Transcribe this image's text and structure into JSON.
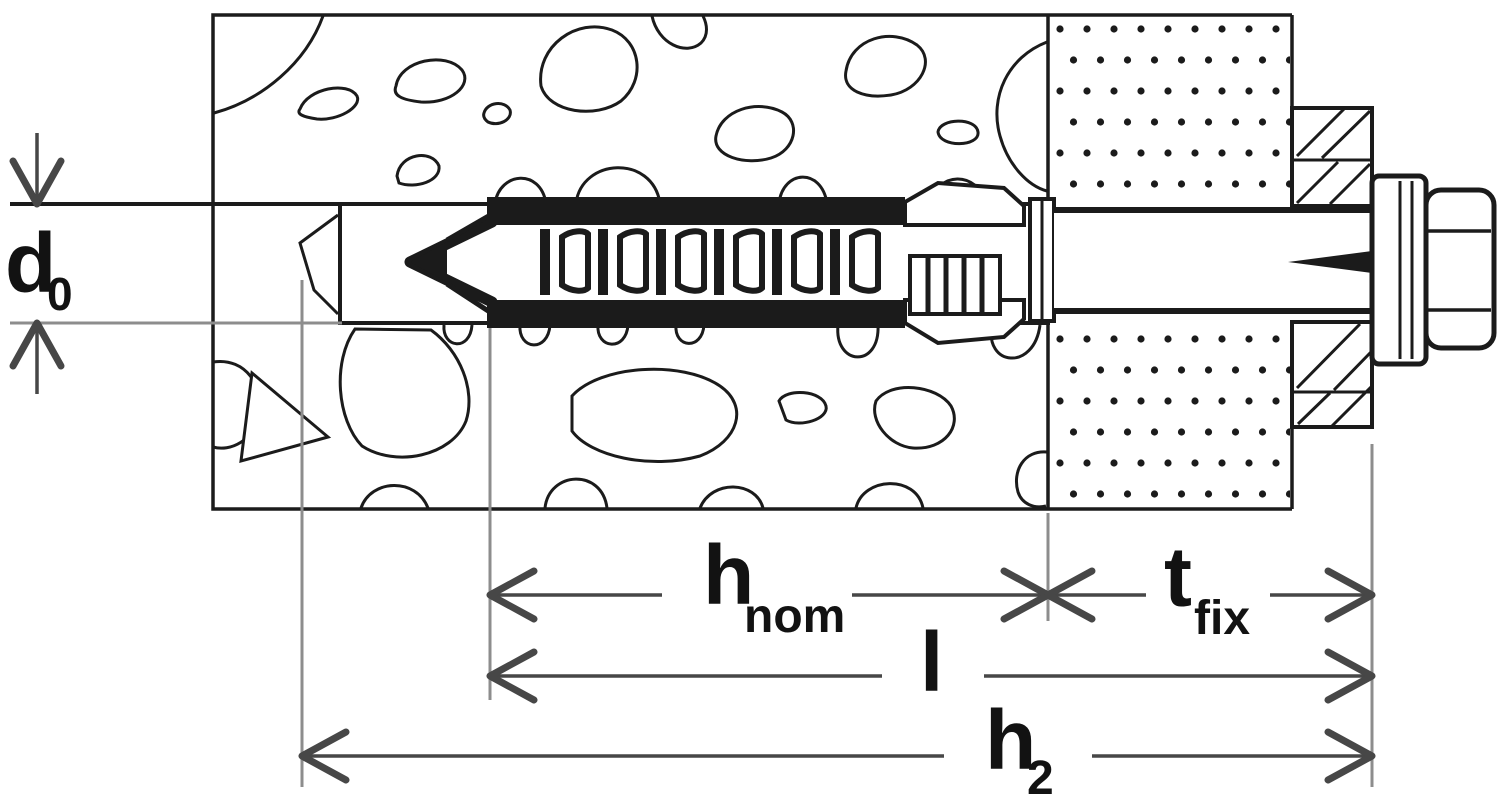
{
  "drawing": {
    "kind": "anchor-installation-cross-section",
    "dimension_labels": {
      "d0": {
        "base": "d",
        "sub": "0"
      },
      "hnom": {
        "base": "h",
        "sub": "nom"
      },
      "tfix": {
        "base": "t",
        "sub": "fix"
      },
      "l": {
        "base": "l",
        "sub": ""
      },
      "h2": {
        "base": "h",
        "sub": "2"
      }
    },
    "colors": {
      "ink": "#1b1b1b",
      "dimension": "#474747",
      "extension": "#8d8d8d",
      "label": "#121212",
      "background": "#ffffff"
    }
  }
}
